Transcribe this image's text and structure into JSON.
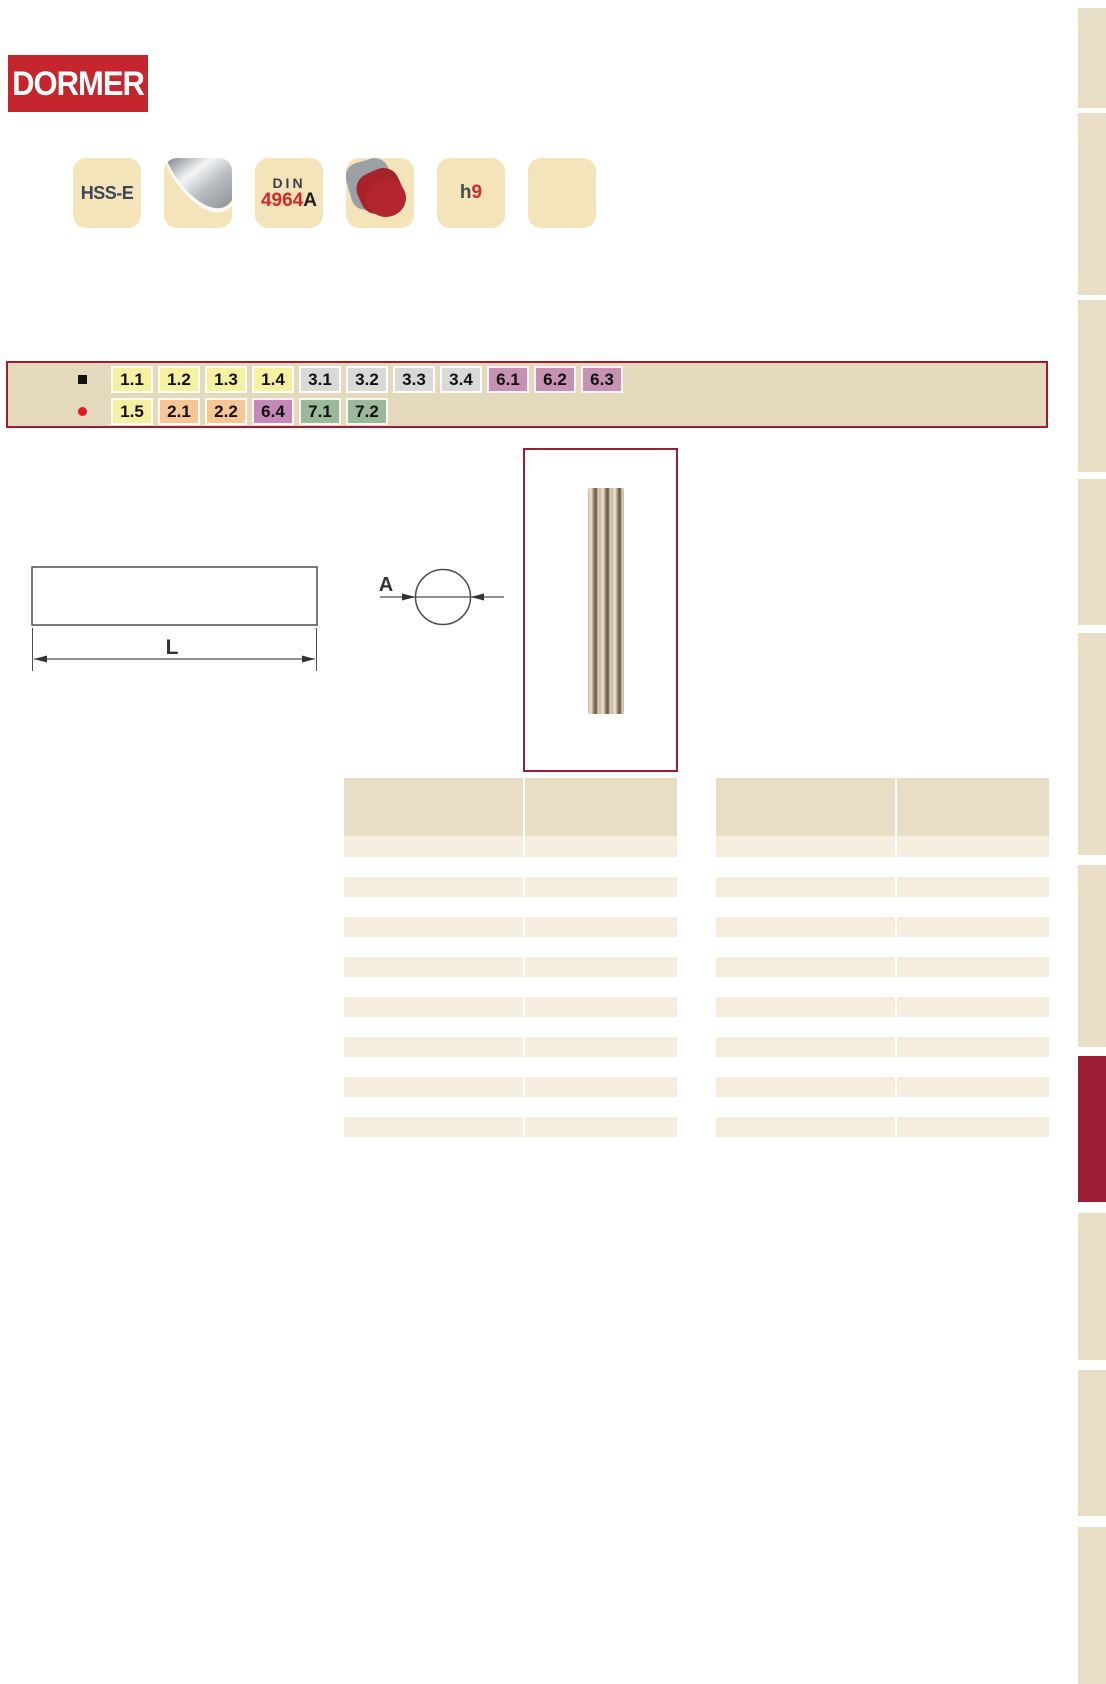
{
  "logo": {
    "text": "DORMER"
  },
  "badges": {
    "items": [
      {
        "name": "material",
        "label": "HSS-E"
      },
      {
        "name": "finish",
        "label": ""
      },
      {
        "name": "standard",
        "line1": "DIN",
        "line2_red": "4964",
        "line2_black": "A"
      },
      {
        "name": "shape",
        "label": ""
      },
      {
        "name": "tolerance",
        "prefix": "h",
        "digit": "9"
      },
      {
        "name": "blank",
        "label": ""
      }
    ]
  },
  "application_band": {
    "rows": [
      {
        "bullet": "black-square",
        "tags": [
          {
            "label": "1.1",
            "bg": "#f6f1a1"
          },
          {
            "label": "1.2",
            "bg": "#f6f1a1"
          },
          {
            "label": "1.3",
            "bg": "#f6f1a1"
          },
          {
            "label": "1.4",
            "bg": "#f6f1a1"
          },
          {
            "label": "3.1",
            "bg": "#d9d9d7"
          },
          {
            "label": "3.2",
            "bg": "#d9d9d7"
          },
          {
            "label": "3.3",
            "bg": "#d9d9d7"
          },
          {
            "label": "3.4",
            "bg": "#d9d9d7"
          },
          {
            "label": "6.1",
            "bg": "#c791b4"
          },
          {
            "label": "6.2",
            "bg": "#c791b4"
          },
          {
            "label": "6.3",
            "bg": "#c791b4"
          }
        ]
      },
      {
        "bullet": "red-dot",
        "tags": [
          {
            "label": "1.5",
            "bg": "#f6f1a1"
          },
          {
            "label": "2.1",
            "bg": "#f6c795"
          },
          {
            "label": "2.2",
            "bg": "#f6c795"
          },
          {
            "label": "6.4",
            "bg": "#c289b9"
          },
          {
            "label": "7.1",
            "bg": "#9cb89b"
          },
          {
            "label": "7.2",
            "bg": "#9cb89b"
          }
        ]
      }
    ]
  },
  "diagram": {
    "length_label": "L",
    "diameter_label": "A"
  },
  "tables": {
    "left": {
      "header_cells": [
        "",
        ""
      ],
      "data_rows": 8
    },
    "right": {
      "header_cells": [
        "",
        ""
      ],
      "data_rows": 8
    }
  },
  "sidebar": {
    "tabs": [
      {
        "active": false
      },
      {
        "active": false
      },
      {
        "active": false
      },
      {
        "active": false
      },
      {
        "active": false
      },
      {
        "active": false
      },
      {
        "active": true
      },
      {
        "active": false
      },
      {
        "active": false
      },
      {
        "active": false
      }
    ]
  },
  "colors": {
    "logo_red": "#c5262d",
    "accent_maroon": "#9c1c33",
    "band_bg": "#e4d9bc",
    "badge_bg": "#f3e4ba",
    "table_header_bg": "#e8dec6",
    "table_row_bg": "#f5edde",
    "sidebar_tab_bg": "#e8dec6",
    "drawing_line": "#4d4d4d",
    "bullet_red": "#e01b22"
  }
}
